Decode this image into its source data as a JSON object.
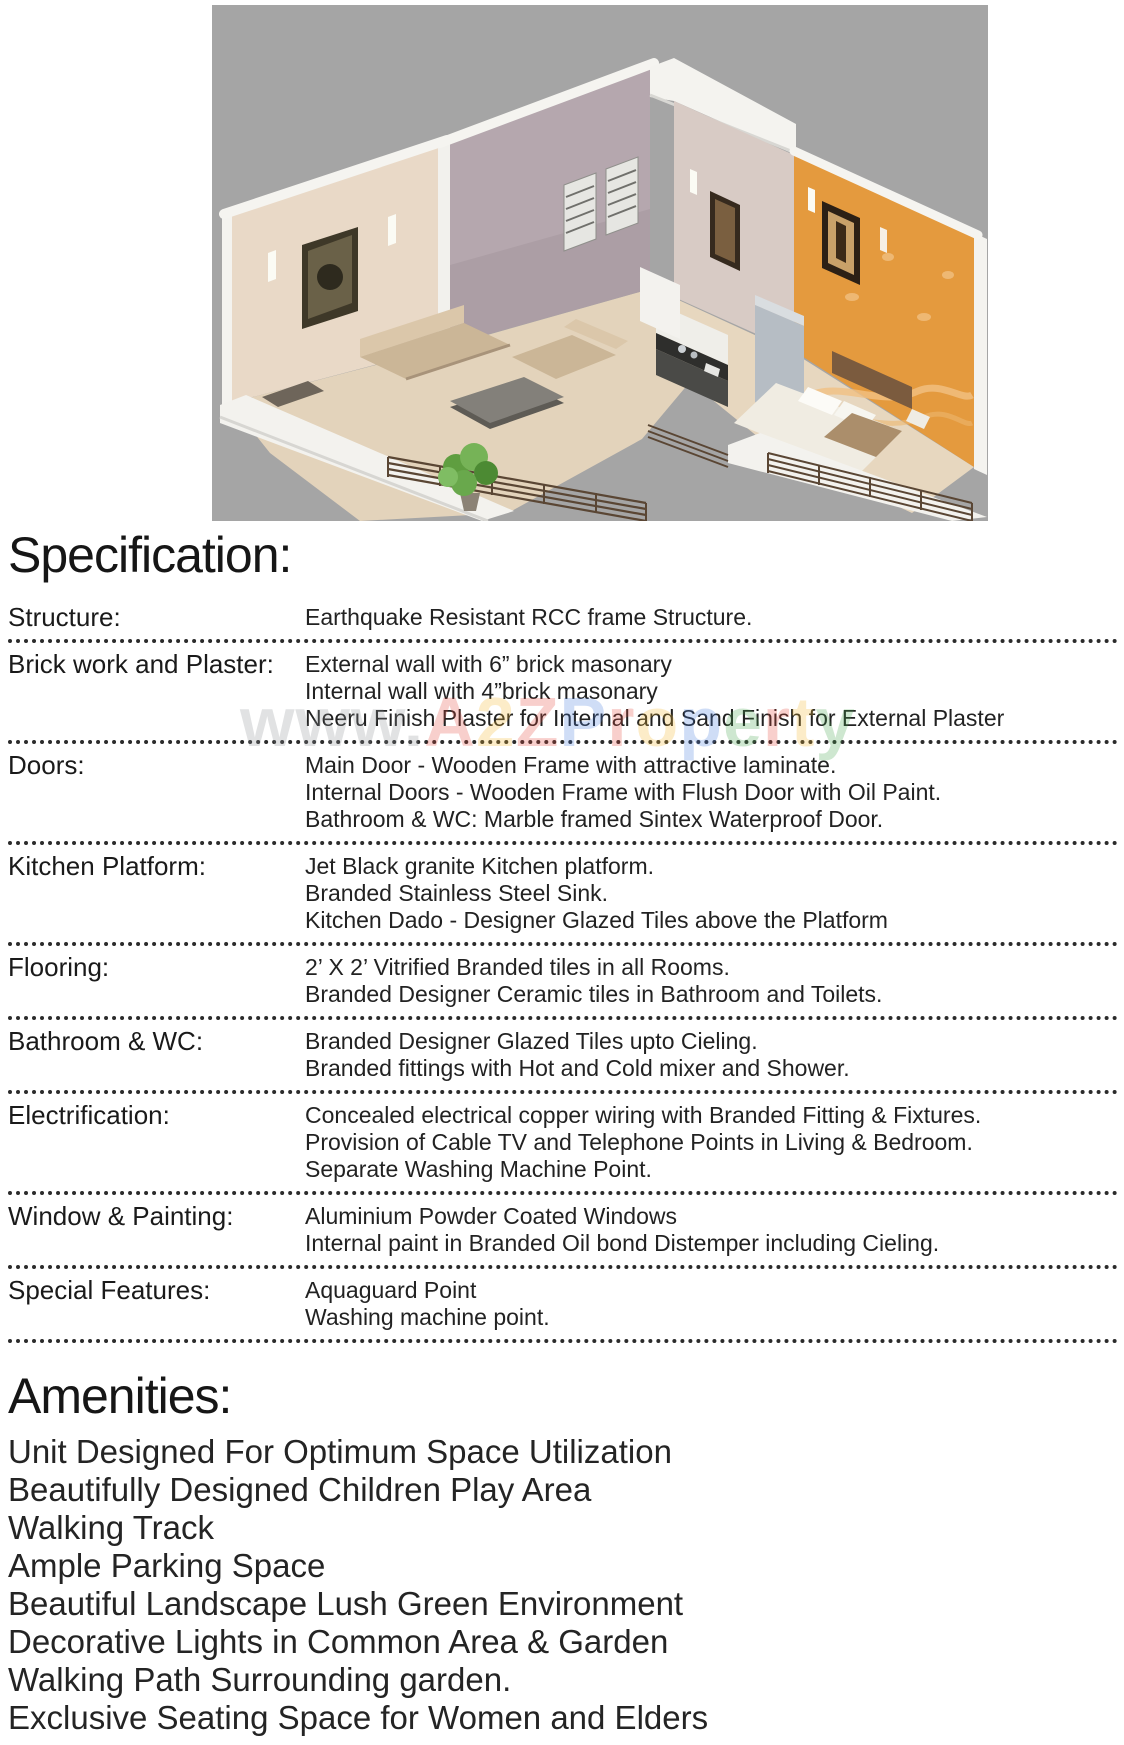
{
  "colors": {
    "hero_background": "#a5a5a5",
    "text": "#1c1c1c",
    "divider": "#2b2b2b"
  },
  "watermark": {
    "letters": [
      {
        "ch": "w",
        "style": "color:#8e9296"
      },
      {
        "ch": "w",
        "style": "color:#8e9296"
      },
      {
        "ch": "w",
        "style": "color:#8e9296"
      },
      {
        "ch": ".",
        "style": "color:#8e9296"
      },
      {
        "ch": "A",
        "style": "color:#e5493d"
      },
      {
        "ch": "2",
        "style": "color:#f5b82e"
      },
      {
        "ch": "Z",
        "style": "color:#e5493d"
      },
      {
        "ch": "P",
        "style": "color:#4a7fe0"
      },
      {
        "ch": "r",
        "style": "color:#e5493d"
      },
      {
        "ch": "o",
        "style": "color:#f5b82e"
      },
      {
        "ch": "p",
        "style": "color:#4a7fe0"
      },
      {
        "ch": "e",
        "style": "color:#47a64e"
      },
      {
        "ch": "r",
        "style": "color:#e5493d"
      },
      {
        "ch": "t",
        "style": "color:#f5b82e"
      },
      {
        "ch": "y",
        "style": "color:#47a64e"
      }
    ]
  },
  "specification": {
    "title": "Specification:",
    "rows": [
      {
        "label": "Structure:",
        "lines": [
          "Earthquake Resistant RCC frame Structure."
        ]
      },
      {
        "label": "Brick work and Plaster:",
        "lines": [
          "External wall with 6” brick masonary",
          "Internal wall with 4”brick masonary",
          "Neeru Finish Plaster for Internal and Sand Finish for External Plaster"
        ]
      },
      {
        "label": "Doors:",
        "lines": [
          "Main Door - Wooden Frame with attractive laminate.",
          "Internal Doors - Wooden Frame with Flush Door with Oil Paint.",
          "Bathroom & WC: Marble framed Sintex Waterproof Door."
        ]
      },
      {
        "label": "Kitchen Platform:",
        "lines": [
          "Jet Black granite Kitchen platform.",
          "Branded Stainless Steel Sink.",
          "Kitchen Dado - Designer Glazed Tiles above the Platform"
        ]
      },
      {
        "label": "Flooring:",
        "lines": [
          "2’ X 2’ Vitrified Branded tiles in all Rooms.",
          "Branded Designer Ceramic tiles in Bathroom and Toilets."
        ]
      },
      {
        "label": "Bathroom & WC:",
        "lines": [
          "Branded Designer Glazed Tiles upto Cieling.",
          "Branded fittings with Hot and Cold mixer and Shower."
        ]
      },
      {
        "label": "Electrification:",
        "lines": [
          "Concealed electrical copper wiring with Branded Fitting & Fixtures.",
          "Provision of Cable TV and Telephone Points in Living & Bedroom.",
          "Separate Washing Machine Point."
        ]
      },
      {
        "label": "Window & Painting:",
        "lines": [
          "Aluminium Powder Coated Windows",
          "Internal paint in Branded Oil bond Distemper including Cieling."
        ]
      },
      {
        "label": "Special Features:",
        "lines": [
          "Aquaguard Point",
          "Washing machine point."
        ]
      }
    ]
  },
  "amenities": {
    "title": "Amenities:",
    "items": [
      "Unit Designed For Optimum Space Utilization",
      "Beautifully Designed Children Play Area",
      "Walking Track",
      "Ample Parking Space",
      "Beautiful Landscape Lush Green Environment",
      "Decorative Lights in Common Area & Garden",
      "Walking Path Surrounding garden.",
      "Exclusive Seating Space for Women and Elders"
    ]
  }
}
